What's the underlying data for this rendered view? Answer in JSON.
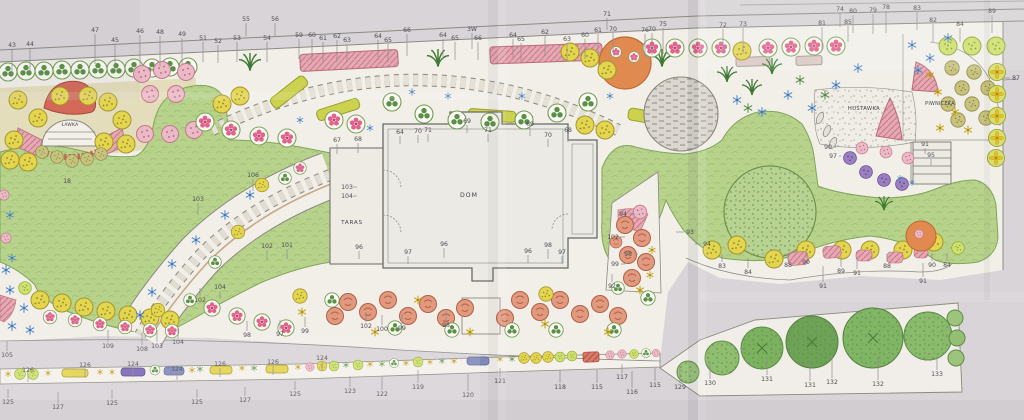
{
  "labels": {
    "house": "DOM",
    "terrace": "TARAS",
    "bench": "ŁAWKA",
    "swing": "HUŚTAWKA",
    "cellar": "PIWNICZKA"
  },
  "palette": {
    "paper": "#d8d4d7",
    "drawing_paper": "#f2efe9",
    "lawn_green": "#b7d28b",
    "tree_green": "#6ea257",
    "flower_pink": "#e0638b",
    "hedge_pink": "#e7a8b3",
    "plant_yellow": "#e4d54f",
    "plant_lime": "#cfe06c",
    "accent_blue": "#4f86c8",
    "accent_purple": "#9a7fc1",
    "red_shrub": "#d4695a",
    "orange_tree": "#e08a4f",
    "gravel_gray": "#dbd7d0",
    "pencil": "#8b8b85"
  },
  "annotations": [
    [
      "43",
      12,
      47,
      0,
      26
    ],
    [
      "44",
      30,
      46,
      0,
      26
    ],
    [
      "47",
      95,
      32,
      0,
      30
    ],
    [
      "45",
      115,
      42,
      0,
      26
    ],
    [
      "46",
      140,
      33,
      0,
      30
    ],
    [
      "48",
      160,
      34,
      0,
      30
    ],
    [
      "49",
      182,
      36,
      0,
      26
    ],
    [
      "51",
      203,
      40,
      0,
      20
    ],
    [
      "52",
      218,
      43,
      0,
      18
    ],
    [
      "53",
      237,
      40,
      0,
      20
    ],
    [
      "54",
      267,
      40,
      0,
      20
    ],
    [
      "55",
      246,
      21,
      0,
      13
    ],
    [
      "56",
      275,
      21,
      0,
      13
    ],
    [
      "59",
      299,
      37,
      0,
      20
    ],
    [
      "60",
      312,
      37,
      0,
      22
    ],
    [
      "61",
      323,
      40,
      0,
      20
    ],
    [
      "62",
      337,
      38,
      0,
      22
    ],
    [
      "63",
      347,
      42,
      0,
      18
    ],
    [
      "64",
      378,
      38,
      0,
      20
    ],
    [
      "65",
      388,
      42,
      0,
      18
    ],
    [
      "66",
      407,
      32,
      0,
      22
    ],
    [
      "64",
      443,
      37,
      0,
      20
    ],
    [
      "65",
      455,
      40,
      0,
      18
    ],
    [
      "3W",
      472,
      31,
      0,
      16
    ],
    [
      "66",
      478,
      40,
      0,
      18
    ],
    [
      "64",
      513,
      37,
      0,
      20
    ],
    [
      "65",
      521,
      41,
      0,
      18
    ],
    [
      "62",
      545,
      34,
      0,
      20
    ],
    [
      "63",
      567,
      41,
      0,
      18
    ],
    [
      "60",
      585,
      37,
      0,
      20
    ],
    [
      "61",
      598,
      32,
      0,
      22
    ],
    [
      "71",
      607,
      16,
      0,
      12
    ],
    [
      "70",
      613,
      31,
      0,
      20
    ],
    [
      "76",
      645,
      32,
      0,
      24
    ],
    [
      "70",
      652,
      31,
      0,
      22
    ],
    [
      "75",
      663,
      26,
      0,
      26
    ],
    [
      "72",
      723,
      27,
      0,
      24
    ],
    [
      "73",
      743,
      26,
      0,
      26
    ],
    [
      "81",
      822,
      25,
      0,
      24
    ],
    [
      "74",
      840,
      11,
      0,
      14
    ],
    [
      "80",
      853,
      13,
      0,
      18
    ],
    [
      "79",
      873,
      12,
      0,
      20
    ],
    [
      "78",
      886,
      9,
      0,
      22
    ],
    [
      "85",
      848,
      24,
      0,
      16
    ],
    [
      "83",
      917,
      10,
      0,
      18
    ],
    [
      "82",
      933,
      22,
      0,
      18
    ],
    [
      "84",
      960,
      26,
      0,
      14
    ],
    [
      "89",
      992,
      13,
      0,
      18
    ],
    [
      "87",
      1016,
      80,
      -12,
      0
    ],
    [
      "67",
      337,
      142,
      0,
      10
    ],
    [
      "68",
      358,
      141,
      0,
      10
    ],
    [
      "64",
      400,
      134,
      0,
      8
    ],
    [
      "70",
      418,
      133,
      0,
      8
    ],
    [
      "71",
      428,
      132,
      0,
      8
    ],
    [
      "69",
      467,
      123,
      0,
      8
    ],
    [
      "71",
      488,
      132,
      0,
      8
    ],
    [
      "69",
      530,
      126,
      0,
      8
    ],
    [
      "70",
      548,
      137,
      0,
      8
    ],
    [
      "68",
      568,
      132,
      0,
      8
    ],
    [
      "103",
      347,
      189,
      10,
      0
    ],
    [
      "104",
      347,
      198,
      10,
      0
    ],
    [
      "96",
      359,
      249,
      0,
      8
    ],
    [
      "97",
      408,
      254,
      0,
      8
    ],
    [
      "96",
      444,
      246,
      0,
      10
    ],
    [
      "96",
      528,
      253,
      0,
      8
    ],
    [
      "98",
      548,
      247,
      0,
      10
    ],
    [
      "97",
      562,
      254,
      0,
      8
    ],
    [
      "18",
      67,
      183,
      0,
      0
    ],
    [
      "106",
      253,
      177,
      0,
      12
    ],
    [
      "103",
      198,
      201,
      0,
      12
    ],
    [
      "102",
      267,
      248,
      0,
      10
    ],
    [
      "101",
      287,
      247,
      0,
      10
    ],
    [
      "104",
      220,
      289,
      0,
      8
    ],
    [
      "98",
      247,
      337,
      0,
      -10
    ],
    [
      "105",
      7,
      357,
      0,
      -10
    ],
    [
      "109",
      108,
      348,
      0,
      -12
    ],
    [
      "108",
      142,
      351,
      0,
      -12
    ],
    [
      "103",
      157,
      348,
      0,
      -12
    ],
    [
      "104",
      178,
      344,
      0,
      -10
    ],
    [
      "102",
      200,
      302,
      0,
      -8
    ],
    [
      "97",
      280,
      336,
      0,
      -10
    ],
    [
      "99",
      305,
      333,
      0,
      -10
    ],
    [
      "102",
      366,
      328,
      0,
      -10
    ],
    [
      "100",
      382,
      331,
      0,
      -10
    ],
    [
      "99",
      402,
      330,
      0,
      -10
    ],
    [
      "98",
      446,
      327,
      0,
      -10
    ],
    [
      "94",
      623,
      216,
      12,
      0
    ],
    [
      "102",
      613,
      239,
      12,
      0
    ],
    [
      "98",
      628,
      256,
      10,
      0
    ],
    [
      "99",
      615,
      266,
      10,
      0
    ],
    [
      "92",
      612,
      288,
      0,
      -8
    ],
    [
      "93",
      690,
      234,
      -14,
      0
    ],
    [
      "94",
      707,
      246,
      -12,
      0
    ],
    [
      "83",
      722,
      268,
      0,
      -8
    ],
    [
      "84",
      748,
      274,
      0,
      -10
    ],
    [
      "88",
      788,
      267,
      0,
      -8
    ],
    [
      "90",
      806,
      264,
      0,
      -8
    ],
    [
      "91",
      823,
      288,
      0,
      -16
    ],
    [
      "89",
      841,
      273,
      0,
      -10
    ],
    [
      "91",
      857,
      275,
      0,
      -12
    ],
    [
      "88",
      887,
      268,
      0,
      -8
    ],
    [
      "91",
      923,
      283,
      0,
      -14
    ],
    [
      "90",
      932,
      267,
      0,
      -8
    ],
    [
      "84",
      947,
      267,
      0,
      -8
    ],
    [
      "90",
      828,
      149,
      8,
      0
    ],
    [
      "97",
      833,
      158,
      8,
      0
    ],
    [
      "91",
      925,
      146,
      0,
      6
    ],
    [
      "95",
      931,
      157,
      0,
      6
    ],
    [
      "126",
      28,
      372,
      0,
      8
    ],
    [
      "126",
      85,
      367,
      0,
      9
    ],
    [
      "124",
      133,
      366,
      0,
      9
    ],
    [
      "124",
      177,
      371,
      0,
      7
    ],
    [
      "126",
      220,
      366,
      0,
      9
    ],
    [
      "126",
      273,
      364,
      0,
      9
    ],
    [
      "124",
      322,
      360,
      0,
      9
    ],
    [
      "125",
      8,
      404,
      0,
      -9
    ],
    [
      "127",
      58,
      409,
      0,
      -11
    ],
    [
      "125",
      112,
      405,
      0,
      -9
    ],
    [
      "125",
      197,
      404,
      0,
      -9
    ],
    [
      "127",
      245,
      402,
      0,
      -9
    ],
    [
      "125",
      295,
      396,
      0,
      -9
    ],
    [
      "123",
      350,
      393,
      0,
      -11
    ],
    [
      "122",
      382,
      396,
      0,
      -13
    ],
    [
      "119",
      418,
      389,
      0,
      -13
    ],
    [
      "120",
      468,
      397,
      0,
      -17
    ],
    [
      "121",
      500,
      383,
      0,
      -9
    ],
    [
      "118",
      560,
      389,
      0,
      -13
    ],
    [
      "115",
      597,
      389,
      0,
      -13
    ],
    [
      "117",
      622,
      379,
      0,
      -9
    ],
    [
      "116",
      632,
      394,
      0,
      -17
    ],
    [
      "115",
      655,
      387,
      0,
      -13
    ],
    [
      "129",
      680,
      389,
      0,
      -16
    ],
    [
      "130",
      710,
      385,
      0,
      -18
    ],
    [
      "131",
      767,
      381,
      0,
      -18
    ],
    [
      "131",
      810,
      387,
      0,
      -22
    ],
    [
      "132",
      832,
      384,
      0,
      -20
    ],
    [
      "132",
      878,
      386,
      0,
      -24
    ],
    [
      "133",
      937,
      376,
      0,
      -14
    ]
  ]
}
